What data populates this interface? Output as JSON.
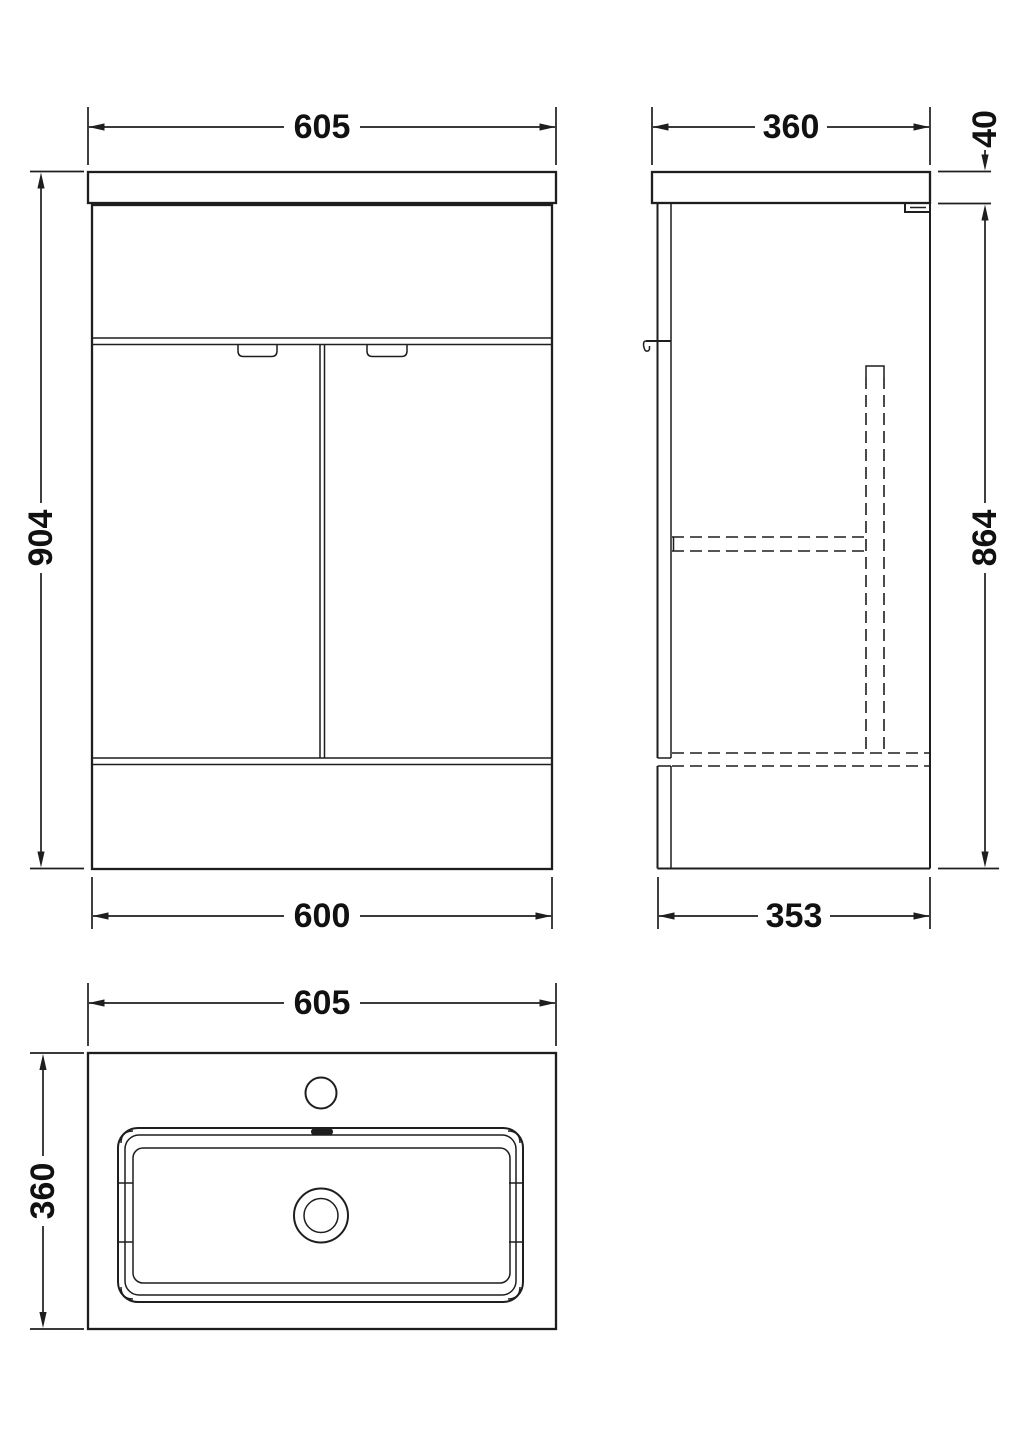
{
  "drawing": {
    "title": "vanity-unit-technical-drawing",
    "line_color": "#1f1d1e",
    "background_color": "#ffffff",
    "text_color": "#111111",
    "views": {
      "front": {
        "dims": {
          "width_top": "605",
          "height": "904",
          "width_bottom": "600"
        }
      },
      "side": {
        "dims": {
          "depth_top": "360",
          "worktop_thickness": "40",
          "cabinet_height": "864",
          "depth_bottom": "353"
        }
      },
      "plan": {
        "dims": {
          "width_top": "605",
          "depth_left": "360"
        }
      }
    }
  }
}
